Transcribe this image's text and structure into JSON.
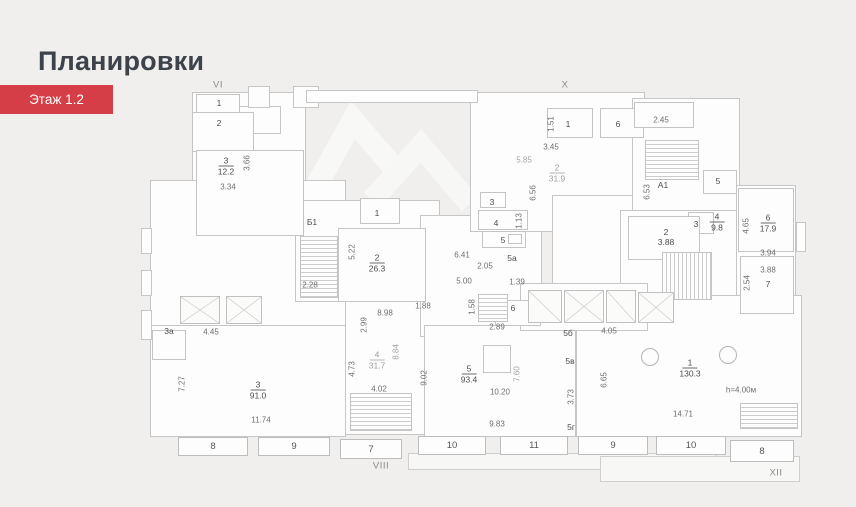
{
  "header": {
    "title": "Планировки"
  },
  "floor_selector": {
    "label": "Этаж 1.2"
  },
  "colors": {
    "background": "#f0efee",
    "accent": "#d63e47",
    "plan_fill": "#fdfdfd",
    "plan_line": "#c6c6c6"
  },
  "plan": {
    "axis_labels": [
      {
        "t": "VI",
        "x": 218,
        "y": 85
      },
      {
        "t": "X",
        "x": 565,
        "y": 85
      },
      {
        "t": "VIII",
        "x": 381,
        "y": 466
      },
      {
        "t": "XII",
        "x": 776,
        "y": 473
      }
    ],
    "dimensions": [
      {
        "t": "3.66",
        "x": 247,
        "y": 163,
        "v": 1
      },
      {
        "t": "3.34",
        "x": 228,
        "y": 187
      },
      {
        "t": "5.22",
        "x": 352,
        "y": 252,
        "v": 1
      },
      {
        "t": "2.28",
        "x": 310,
        "y": 285
      },
      {
        "t": "1.51",
        "x": 551,
        "y": 124,
        "v": 1
      },
      {
        "t": "3.45",
        "x": 551,
        "y": 147
      },
      {
        "t": "5.85",
        "x": 524,
        "y": 160,
        "light": 1
      },
      {
        "t": "6.56",
        "x": 533,
        "y": 193,
        "v": 1
      },
      {
        "t": "1.13",
        "x": 519,
        "y": 221,
        "v": 1
      },
      {
        "t": "2.45",
        "x": 661,
        "y": 120
      },
      {
        "t": "6.53",
        "x": 647,
        "y": 192,
        "v": 1
      },
      {
        "t": "4.65",
        "x": 746,
        "y": 226,
        "v": 1
      },
      {
        "t": "3.94",
        "x": 768,
        "y": 253
      },
      {
        "t": "3.88",
        "x": 768,
        "y": 270
      },
      {
        "t": "2.54",
        "x": 747,
        "y": 283,
        "v": 1
      },
      {
        "t": "6.41",
        "x": 462,
        "y": 255
      },
      {
        "t": "2.05",
        "x": 485,
        "y": 266
      },
      {
        "t": "5.00",
        "x": 464,
        "y": 281
      },
      {
        "t": "1.39",
        "x": 517,
        "y": 282
      },
      {
        "t": "1.58",
        "x": 472,
        "y": 307,
        "v": 1
      },
      {
        "t": "2.89",
        "x": 497,
        "y": 327
      },
      {
        "t": "1.88",
        "x": 423,
        "y": 306
      },
      {
        "t": "8.98",
        "x": 385,
        "y": 313
      },
      {
        "t": "2.99",
        "x": 364,
        "y": 325,
        "v": 1
      },
      {
        "t": "4.45",
        "x": 211,
        "y": 332
      },
      {
        "t": "7.27",
        "x": 182,
        "y": 384,
        "v": 1
      },
      {
        "t": "11.74",
        "x": 261,
        "y": 420
      },
      {
        "t": "4.73",
        "x": 352,
        "y": 369,
        "v": 1
      },
      {
        "t": "8.84",
        "x": 396,
        "y": 352,
        "v": 1,
        "light": 1
      },
      {
        "t": "4.02",
        "x": 379,
        "y": 389
      },
      {
        "t": "9.02",
        "x": 424,
        "y": 378,
        "v": 1
      },
      {
        "t": "10.20",
        "x": 500,
        "y": 392
      },
      {
        "t": "7.60",
        "x": 517,
        "y": 374,
        "v": 1,
        "light": 1
      },
      {
        "t": "9.83",
        "x": 497,
        "y": 424
      },
      {
        "t": "3.73",
        "x": 571,
        "y": 397,
        "v": 1
      },
      {
        "t": "6.65",
        "x": 604,
        "y": 380,
        "v": 1
      },
      {
        "t": "4.05",
        "x": 609,
        "y": 331
      },
      {
        "t": "14.71",
        "x": 683,
        "y": 414
      },
      {
        "t": "h=4.00м",
        "x": 741,
        "y": 390
      }
    ],
    "room_areas": [
      {
        "n": "3",
        "a": "12.2",
        "x": 226,
        "y": 166
      },
      {
        "n": "2",
        "a": "26.3",
        "x": 377,
        "y": 263
      },
      {
        "n": "2",
        "a": "31.9",
        "x": 557,
        "y": 173,
        "light": 1
      },
      {
        "n": "4",
        "a": "9.8",
        "x": 717,
        "y": 222
      },
      {
        "n": "6",
        "a": "17.9",
        "x": 768,
        "y": 223
      },
      {
        "n": "3",
        "a": "91.0",
        "x": 258,
        "y": 390
      },
      {
        "n": "4",
        "a": "31.7",
        "x": 377,
        "y": 360,
        "light": 1
      },
      {
        "n": "5",
        "a": "93.4",
        "x": 469,
        "y": 374
      },
      {
        "n": "1",
        "a": "130.3",
        "x": 690,
        "y": 368
      },
      {
        "n": "2",
        "a": "3.88",
        "x": 666,
        "y": 237,
        "noline": 1
      }
    ],
    "room_ids": [
      {
        "t": "1",
        "x": 219,
        "y": 103
      },
      {
        "t": "2",
        "x": 219,
        "y": 123
      },
      {
        "t": "Б1",
        "x": 312,
        "y": 222
      },
      {
        "t": "1",
        "x": 377,
        "y": 213
      },
      {
        "t": "3",
        "x": 492,
        "y": 202
      },
      {
        "t": "4",
        "x": 496,
        "y": 223
      },
      {
        "t": "5",
        "x": 503,
        "y": 240
      },
      {
        "t": "5а",
        "x": 512,
        "y": 258
      },
      {
        "t": "1",
        "x": 568,
        "y": 124
      },
      {
        "t": "6",
        "x": 618,
        "y": 124
      },
      {
        "t": "А1",
        "x": 663,
        "y": 185
      },
      {
        "t": "3",
        "x": 696,
        "y": 224
      },
      {
        "t": "5",
        "x": 718,
        "y": 181
      },
      {
        "t": "7",
        "x": 768,
        "y": 284
      },
      {
        "t": "6",
        "x": 513,
        "y": 308
      },
      {
        "t": "5б",
        "x": 568,
        "y": 333
      },
      {
        "t": "5в",
        "x": 570,
        "y": 361
      },
      {
        "t": "5г",
        "x": 571,
        "y": 427
      },
      {
        "t": "3а",
        "x": 169,
        "y": 331
      }
    ],
    "window_bays": [
      {
        "t": "8",
        "x": 178,
        "y": 437,
        "w": 70,
        "h": 19
      },
      {
        "t": "9",
        "x": 258,
        "y": 437,
        "w": 72,
        "h": 19
      },
      {
        "t": "7",
        "x": 340,
        "y": 439,
        "w": 62,
        "h": 20
      },
      {
        "t": "10",
        "x": 418,
        "y": 436,
        "w": 68,
        "h": 19
      },
      {
        "t": "11",
        "x": 500,
        "y": 436,
        "w": 68,
        "h": 19
      },
      {
        "t": "9",
        "x": 578,
        "y": 436,
        "w": 70,
        "h": 19
      },
      {
        "t": "10",
        "x": 656,
        "y": 436,
        "w": 70,
        "h": 19
      },
      {
        "t": "8",
        "x": 730,
        "y": 440,
        "w": 64,
        "h": 22
      }
    ]
  }
}
